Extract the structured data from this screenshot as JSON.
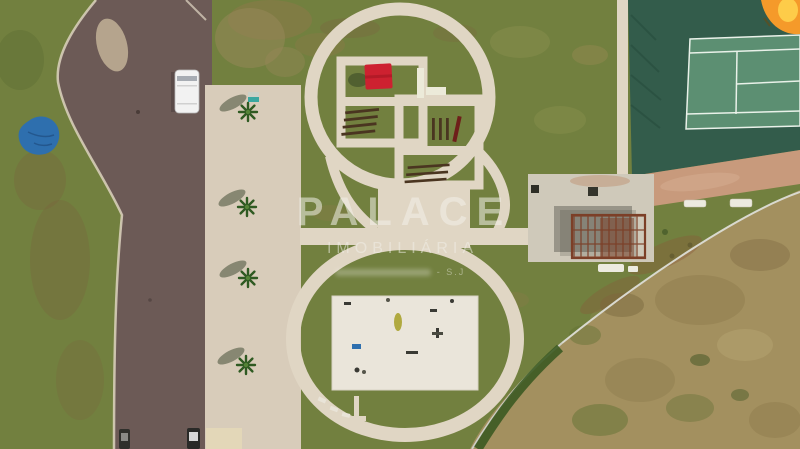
{
  "watermark": {
    "title": "PALACE",
    "subtitle": "IMOBILIÁRIA",
    "tagline_suffix": "- S.J"
  },
  "colors": {
    "grass": "#72803f",
    "road": "#6c5a56",
    "sidewalk": "#d8ccba",
    "path": "#e0d6c4",
    "plaza": "#eae5da",
    "concrete": "#cfc9ba",
    "courtOuter": "#335c4b",
    "courtInner": "#5c8f72",
    "courtLine": "#e9f1e9",
    "clay": "#c89a7c",
    "scrub": "#a3905f",
    "hedge": "#3c5a22",
    "pergola": "#7c3f27",
    "wood": "#4a3520",
    "canopyRed": "#cd2130",
    "tarpBlue": "#2e6fae",
    "van": "#f2f2f2",
    "palm": "#2f5a22",
    "logoOrange": "#f59a2a",
    "logoYellow": "#ffd24d",
    "watermark": "rgba(242,240,234,0.55)"
  }
}
